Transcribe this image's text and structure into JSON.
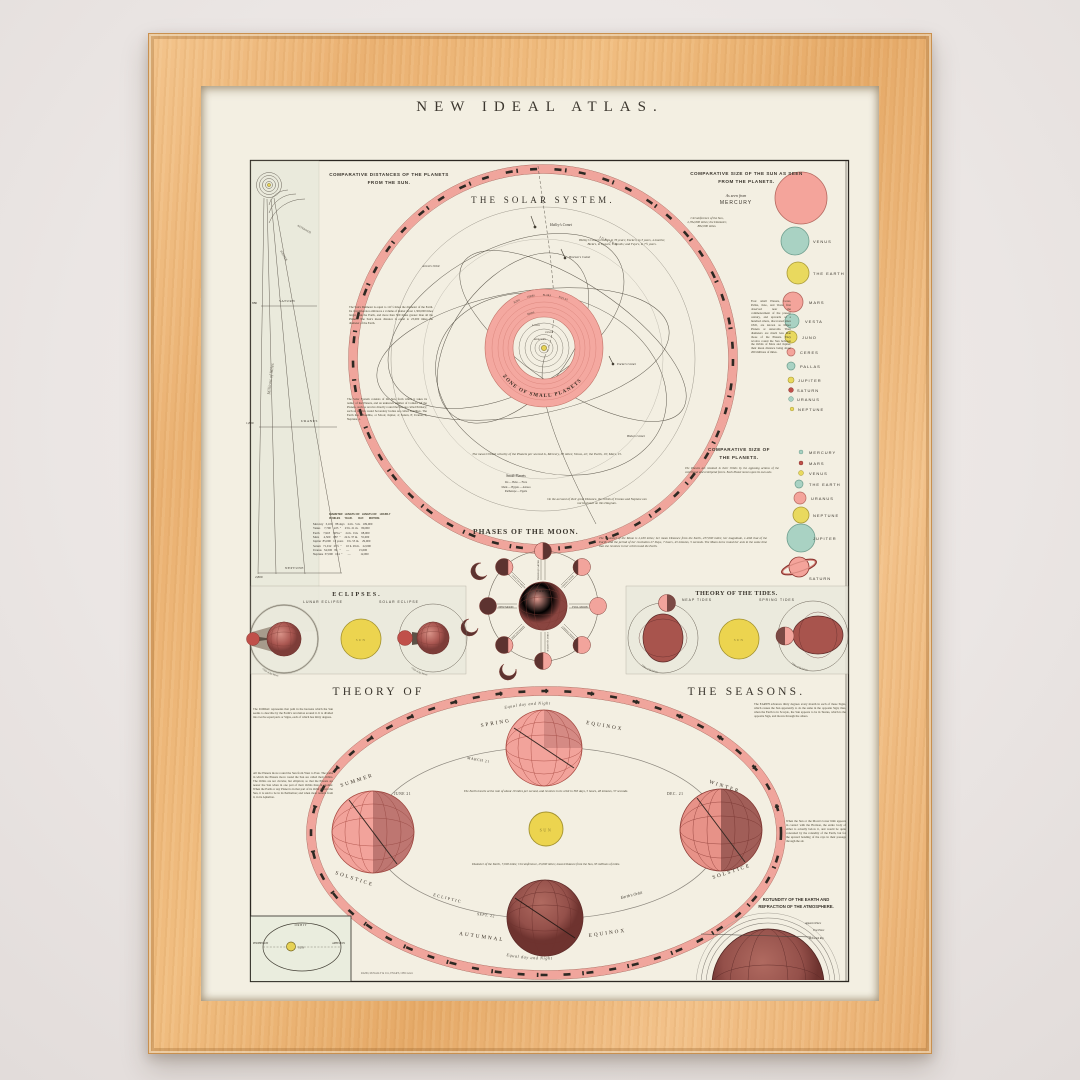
{
  "poster": {
    "title": "NEW IDEAL ATLAS."
  },
  "imprint": "RAND, McNALLY & CO., ENGR'S, CHICAGO.",
  "dist": {
    "t1": "COMPARATIVE DISTANCES OF THE PLANETS",
    "t2": "FROM THE SUN.",
    "scale": "Millions of Miles",
    "asteroids": "ASTEROIDS",
    "jupiter": "JUPITER",
    "ticks": [
      {
        "planet": "SATURN",
        "value": "880"
      },
      {
        "planet": "URANUS",
        "value": "1,800"
      },
      {
        "planet": "NEPTUNE",
        "value": "2,800"
      }
    ]
  },
  "solar": {
    "title": "THE SOLAR SYSTEM.",
    "zone": "ZONE  OF  SMALL  PLANETS",
    "jupiter": "JUPITER",
    "arrest": "Arrest's Orbit",
    "halley": "Halley's Comet",
    "brorsen": "Brorsen's Comet",
    "encke": "Encke's Comet",
    "biela": "Biela's Comet",
    "inner": [
      "EARTH",
      "VENUS",
      "MERCURY"
    ],
    "zone_planets": [
      "JUNO",
      "CERES",
      "FLORA",
      "PALLAS",
      "MARS"
    ],
    "note_sun": "The Sun's Diameter is equal to 111½ times the diameter of the Earth. Its circumference embraces a volume of matter about 1,300,000 times larger than the Earth, and more than 500 times greater than all the Planets. The Sun's mean distance is equal to 23,000 times the diameter of the Earth.",
    "note_system": "The Solar System consists of the Sun, from which it takes its name; of the Planets, and an unknown number of Comets. Of the Planets, such as revolve directly round the Sun are called Primary; such as revolve round Secondary bodies are called Satellites. The Earth has 1 Satellite, or Moon; Jupiter, 4; Saturn, 8; Uranus, 6; Neptune, 1.",
    "note_velocity": "The mean Orbital velocity of the Planets per second is, Mercury, 30 miles; Venus, 22; the Earth, 19; Mars, 15.",
    "note_comets": "Halley's Comet revolves in 76 years; Encke's, in 3 years, 4 months; Biela's, in 6 years, 9 months; and Faye's, in 7½ years.",
    "note_minor": "Four small Planets, Ceres, Pallas, Juno, and Vesta, first observed near the commencement of the present century, and upwards of a hundred others, discovered since 1845, are known as Minor Planets or Asteroids. Their diameters are much less than those of the Planets. They revolve round the Sun between the Orbits of Mars and Jupiter, their mean distance being about 260 millions of miles.",
    "small_label": "Small Planets",
    "small1": "Iris — Hebe — Flora",
    "small2": "Metis — Hygeia — Astraea",
    "small3": "Parthenope — Egeria",
    "note_uranus": "On the account of their great Distance, the Orbits of Uranus and Neptune can not be shown on this Diagram."
  },
  "table": {
    "h1": "DIAMETER   LENGTH OF   LENGTH OF    HOURLY",
    "h2": "IN MILES      YEAR.        DAY.       MOTION.",
    "rows": [
      "Mercury   3,100    88 days    24 h.  5 m.   109,000",
      "Venus     7,700    225  \"     23 h. 21 m.    80,000",
      "Earth     7,918    365¼ \"     24 h.  0 m.    68,000",
      "Mars      4,500    687  \"     24 h. 37 m.    55,000",
      "Jupiter  85,000   12 years     9 h. 55 m.    29,000",
      "Saturn   71,012   29½  \"      10 h. 29 m.    22,000",
      "Uranus   34,500   84   \"       —             15,000",
      "Neptune  37,000   164  \"       —             12,000"
    ]
  },
  "sunsizes": {
    "t1": "COMPARATIVE SIZE OF THE SUN AS SEEN",
    "t2": "FROM THE PLANETS.",
    "asf": "As seen from",
    "mercury": "MERCURY",
    "note": "Circumference of the Sun,\n2,764,600 miles; the Diameter,\n882,000 miles.",
    "items": [
      {
        "label": "VENUS"
      },
      {
        "label": "THE EARTH"
      },
      {
        "label": "MARS"
      },
      {
        "label": "VESTA"
      },
      {
        "label": "JUNO"
      },
      {
        "label": "CERES"
      },
      {
        "label": "PALLAS"
      },
      {
        "label": "JUPITER"
      },
      {
        "label": "SATURN"
      },
      {
        "label": "URANUS"
      },
      {
        "label": "NEPTUNE"
      }
    ]
  },
  "plsizes": {
    "t1": "COMPARATIVE SIZE OF",
    "t2": "THE PLANETS.",
    "note": "The Planets are retained in their Orbits by the opposing actions of the centrifugal and centripetal forces.  Each Planet moves upon its own axis.",
    "items": [
      {
        "label": "MERCURY"
      },
      {
        "label": "MARS"
      },
      {
        "label": "VENUS"
      },
      {
        "label": "THE EARTH"
      },
      {
        "label": "URANUS"
      },
      {
        "label": "NEPTUNE"
      },
      {
        "label": "JUPITER"
      },
      {
        "label": "SATURN"
      }
    ]
  },
  "moon": {
    "title": "PHASES OF THE MOON.",
    "note": "The Diameter of the Moon is 2,160 miles; her mean Distance from the Earth, 237,000 miles; her magnitude, 1-49th that of the Earth; and the period of her revolution 27 Days, 7 hours, 43 minutes, 5 seconds. The Moon turns round her axis in the same time that she revolves in her orbit round the Earth.",
    "earth": "EARTH",
    "new": "NEW MOON",
    "full": "FULL MOON",
    "fq": "FIRST QUARTER",
    "tq": "THIRD QUARTER",
    "gib": "GIBBOUS MOON",
    "cres": "CRESCENT MOON"
  },
  "ecl": {
    "title": "ECLIPSES.",
    "lunar": "LUNAR ECLIPSE",
    "solar": "SOLAR ECLIPSE",
    "sun": "SUN",
    "orbit": "Orbit of the Moon"
  },
  "tides": {
    "title": "THEORY OF THE TIDES.",
    "neap": "NEAP TIDES",
    "spring": "SPRING TIDES",
    "sun": "SUN",
    "orbit": "Orbit of the Moon"
  },
  "seasons": {
    "title_left": "THEORY   OF",
    "title_right": "THE   SEASONS.",
    "equal_top": "Equal day and Night",
    "equal_bottom": "Equal day and Night",
    "spring": "SPRING",
    "equinox_spring": "EQUINOX",
    "march": "MARCH 21",
    "summer": "SUMMER",
    "solstice_summer": "SOLSTICE",
    "june": "JUNE 21",
    "winter": "WINTER",
    "solstice_winter": "SOLSTICE",
    "dec": "DEC. 21",
    "autumnal": "AUTUMNAL",
    "equinox_autumn": "EQUINOX",
    "sept": "SEPT. 22",
    "sun": "SUN",
    "ecliptic": "ECLIPTIC",
    "earths_orbit": "Earth's Orbit",
    "note_travel": "The Earth travels at the rate of about 19 miles per second, and revolves in its orbit in 365 days, 5 hours, 48 minutes, 57 seconds.",
    "note_earth": "Diameter of the Earth, 7,918 miles;  Circumference, 25,000 miles;  mean Distance from the Sun, 95 millions of miles.",
    "note_zodiac": "The ZODIAC represents that path in the heavens which the Sun seems to describe by the Earth's revolution around it. It is divided into twelve equal parts or Signs, each of which has thirty degrees.",
    "note_orbits": "All the Planets move round the Sun from West to East. The paths in which the Planets move round the Sun are called their Orbits. The Orbits are not circular, but elliptical, so that the Planets are nearer the Sun when in one part of their Orbits than in another. When the Earth or any Planet is in that part of its Orbit nearest the Sun, it is said to be in its Perihelion; and when most remote from it, in its Aphelion.",
    "note_signs": "The EARTH advances thirty degrees every month in each of these Signs, which causes the Sun apparently to do the same in the opposite Sign; thus, when the Earth is in Scorpio, the Sun appears to be in Taurus, which is the opposite Sign, and moves through the others.",
    "note_refraction": "When the Sun or the Moon's lower limb appears in contact with the Horizon, the entire body of either is actually below it, and would be quite concealed by the rotundity of the Earth, but for the upward bending of the rays in their passage through the air."
  },
  "peri": {
    "orbit": "ORBIT",
    "perihelion": "PERIHELION",
    "sun": "SUN",
    "aphelion": "APHELION"
  },
  "rot": {
    "t1": "ROTUNDITY OF THE EARTH AND",
    "t2": "REFRACTION OF THE ATMOSPHERE.",
    "apparent": "Apparent Place",
    "true_place": "True Place",
    "refracted": "Refracted Ray"
  }
}
